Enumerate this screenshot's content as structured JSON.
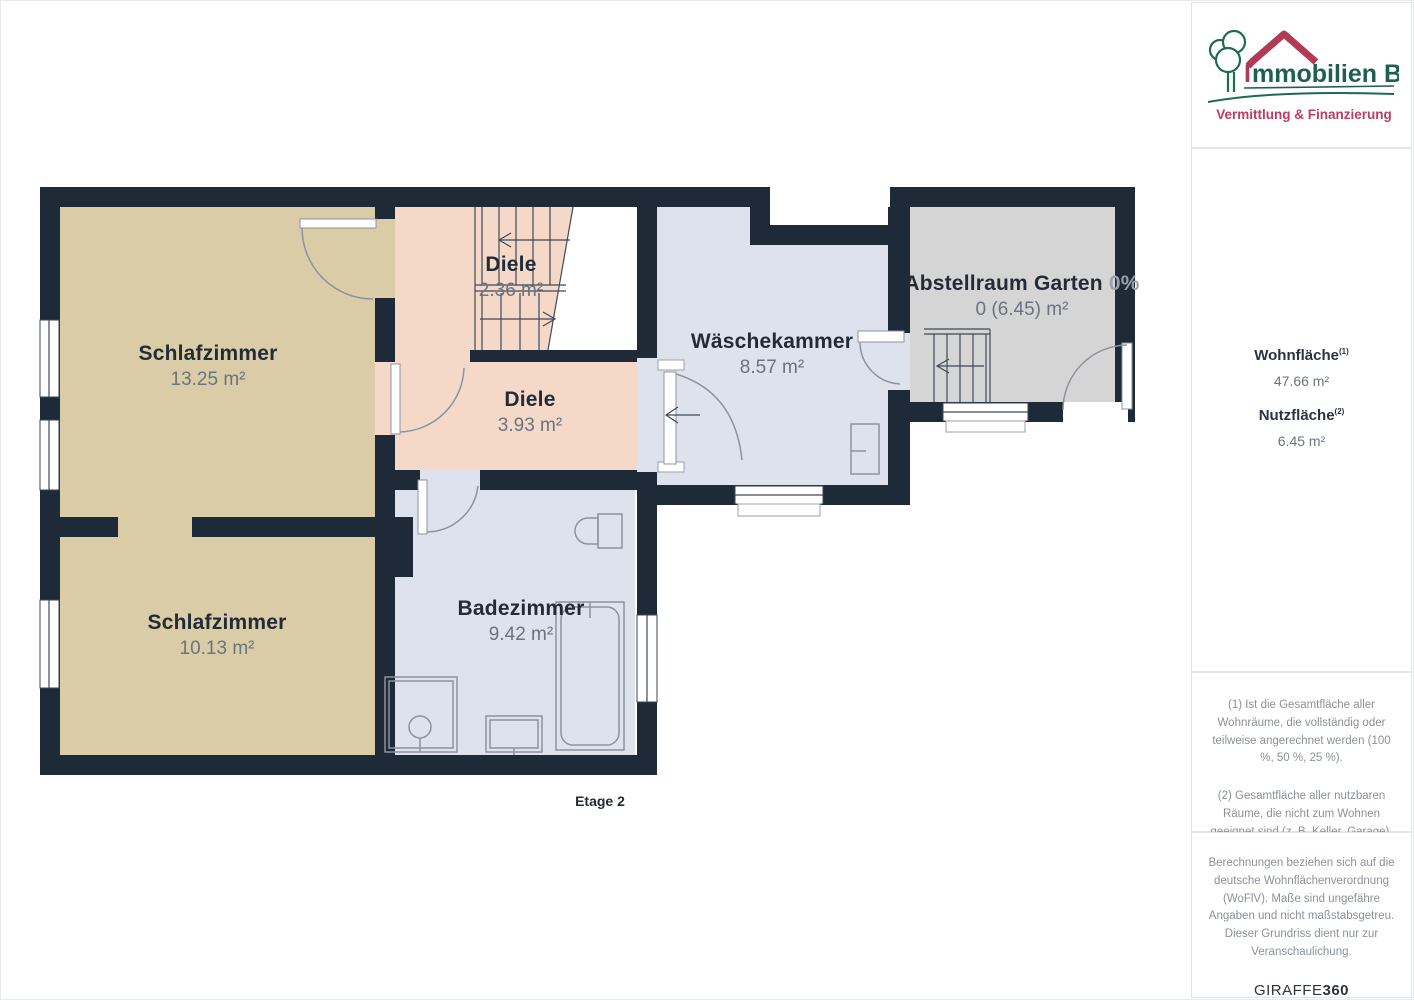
{
  "floorplan": {
    "floor_label": "Etage 2",
    "rooms": [
      {
        "name": "Schlafzimmer",
        "area": "13.25 m²"
      },
      {
        "name": "Diele",
        "area": "2.36 m²"
      },
      {
        "name": "Diele",
        "area": "3.93 m²"
      },
      {
        "name": "Wäschekammer",
        "area": "8.57 m²"
      },
      {
        "name": "Abstellraum Garten",
        "percent": "0%",
        "area": "0 (6.45) m²"
      },
      {
        "name": "Schlafzimmer",
        "area": "10.13 m²"
      },
      {
        "name": "Badezimmer",
        "area": "9.42 m²"
      }
    ],
    "colors": {
      "wall": "#1f2a38",
      "bedroom": "#d9cca6",
      "hallway": "#f5d9c8",
      "bathroom": "#dde2ec",
      "storage": "#d5d5d6"
    }
  },
  "sidebar": {
    "logo": {
      "title_initial": "I",
      "title_rest": "mmobilien Bart",
      "subtitle": "Vermittlung & Finanzierung",
      "colors": {
        "green": "#1d5f52",
        "red": "#c23a60",
        "roof": "#b13b54"
      }
    },
    "metrics": [
      {
        "label": "Wohnfläche",
        "sup": "(1)",
        "value": "47.66 m²"
      },
      {
        "label": "Nutzfläche",
        "sup": "(2)",
        "value": "6.45 m²"
      }
    ],
    "footnotes": [
      "(1) Ist die Gesamtfläche aller Wohnräume, die vollständig oder teilweise angerechnet werden (100 %, 50 %, 25 %).",
      "(2) Gesamtfläche aller nutzbaren Räume, die nicht zum Wohnen geeignet sind (z. B. Keller, Garage)."
    ],
    "disclaimer": "Berechnungen beziehen sich auf die deutsche Wohnflächenverordnung (WoFlV). Maße sind ungefähre Angaben und nicht maßstabsgetreu. Dieser Grundriss dient nur zur Veranschaulichung.",
    "brand": {
      "name": "GIRAFFE",
      "suffix": "360"
    }
  }
}
